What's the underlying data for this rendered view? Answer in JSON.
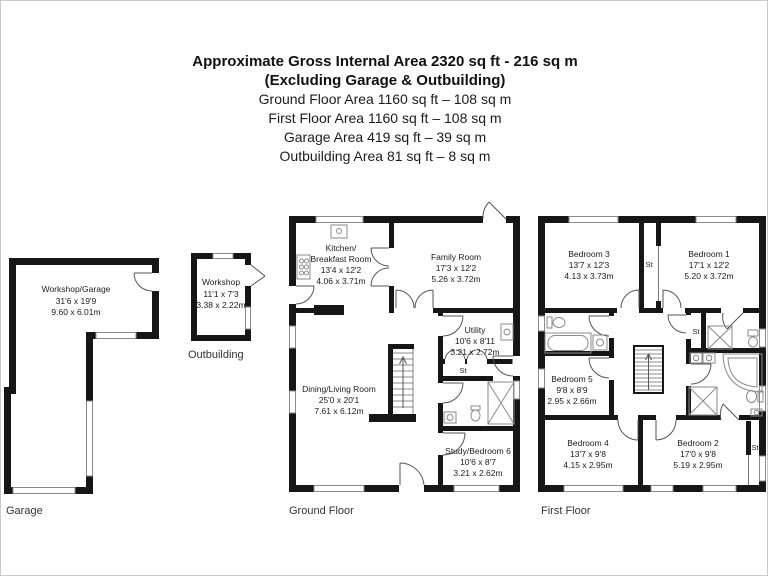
{
  "header": {
    "title_line1": "Approximate Gross Internal Area 2320 sq ft - 216 sq m",
    "title_line2": "(Excluding Garage & Outbuilding)",
    "area_lines": [
      "Ground Floor Area 1160 sq ft – 108 sq m",
      "First Floor Area 1160 sq ft – 108 sq m",
      "Garage Area 419 sq ft – 39 sq m",
      "Outbuilding Area 81 sq ft – 8 sq m"
    ]
  },
  "plans": {
    "garage": {
      "label": "Garage",
      "rooms": {
        "workshop_garage": {
          "name": "Workshop/Garage",
          "imperial": "31'6 x 19'9",
          "metric": "9.60 x 6.01m"
        }
      }
    },
    "outbuilding": {
      "label": "Outbuilding",
      "rooms": {
        "workshop": {
          "name": "Workshop",
          "imperial": "11'1 x 7'3",
          "metric": "3.38 x 2.22m"
        }
      }
    },
    "ground_floor": {
      "label": "Ground Floor",
      "rooms": {
        "kitchen": {
          "name_line1": "Kitchen/",
          "name_line2": "Breakfast Room",
          "imperial": "13'4 x 12'2",
          "metric": "4.06 x 3.71m"
        },
        "family_room": {
          "name": "Family Room",
          "imperial": "17'3 x 12'2",
          "metric": "5.26 x 3.72m"
        },
        "utility": {
          "name": "Utility",
          "imperial": "10'6 x 8'11",
          "metric": "3.21 x 2.72m"
        },
        "store": {
          "name": "St"
        },
        "dining_living": {
          "name": "Dining/Living Room",
          "imperial": "25'0 x 20'1",
          "metric": "7.61 x 6.12m"
        },
        "study_bedroom6": {
          "name": "Study/Bedroom 6",
          "imperial": "10'6 x 8'7",
          "metric": "3.21 x 2.62m"
        }
      }
    },
    "first_floor": {
      "label": "First Floor",
      "rooms": {
        "bedroom3": {
          "name": "Bedroom 3",
          "imperial": "13'7 x 12'3",
          "metric": "4.13 x 3.73m"
        },
        "bedroom1": {
          "name": "Bedroom 1",
          "imperial": "17'1 x 12'2",
          "metric": "5.20 x 3.72m"
        },
        "bedroom5": {
          "name": "Bedroom 5",
          "imperial": "9'8 x 8'9",
          "metric": "2.95 x 2.66m"
        },
        "bedroom4": {
          "name": "Bedroom 4",
          "imperial": "13'7 x 9'8",
          "metric": "4.15 x 2.95m"
        },
        "bedroom2": {
          "name": "Bedroom 2",
          "imperial": "17'0 x 9'8",
          "metric": "5.19 x 2.95m"
        },
        "store_landing": {
          "name": "St"
        },
        "store_hall": {
          "name": "St"
        },
        "store_bedroom2": {
          "name": "St"
        }
      }
    }
  },
  "colors": {
    "wall": "#161616",
    "window_line": "#8a8a8a",
    "door_line": "#555555",
    "fixture_line": "#8a8a8a",
    "text": "#222222"
  }
}
